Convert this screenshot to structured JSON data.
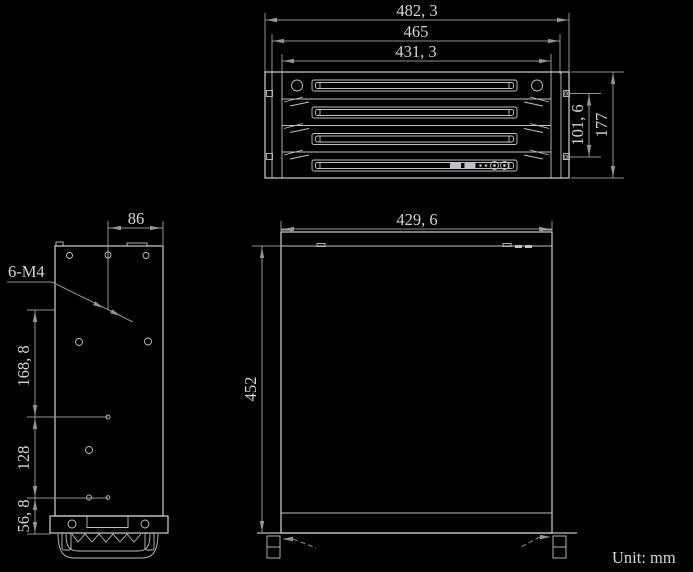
{
  "meta": {
    "unit_note": "Unit: mm",
    "drawing_type": "chassis-dimension-drawing"
  },
  "colors": {
    "background": "#000000",
    "object_line": "#bfc3c3",
    "dim_line": "#909494",
    "text": "#d3d7d7"
  },
  "front_view": {
    "dims": {
      "overall_width": {
        "label": "482, 3",
        "value_mm": 482.3
      },
      "mid_width": {
        "label": "465",
        "value_mm": 465
      },
      "body_width": {
        "label": "431, 3",
        "value_mm": 431.3
      },
      "ear_slot_spacing": {
        "label": "101, 6",
        "value_mm": 101.6
      },
      "height": {
        "label": "177",
        "value_mm": 177
      }
    }
  },
  "side_view": {
    "dims": {
      "hole_offset": {
        "label": "86",
        "value_mm": 86
      },
      "hole_callout": {
        "label": "6-M4"
      },
      "span_top": {
        "label": "168, 8",
        "value_mm": 168.8
      },
      "span_mid": {
        "label": "128",
        "value_mm": 128
      },
      "span_bottom": {
        "label": "56, 8",
        "value_mm": 56.8
      }
    }
  },
  "top_view": {
    "dims": {
      "body_width": {
        "label": "429, 6",
        "value_mm": 429.6
      },
      "depth": {
        "label": "452",
        "value_mm": 452
      }
    }
  }
}
